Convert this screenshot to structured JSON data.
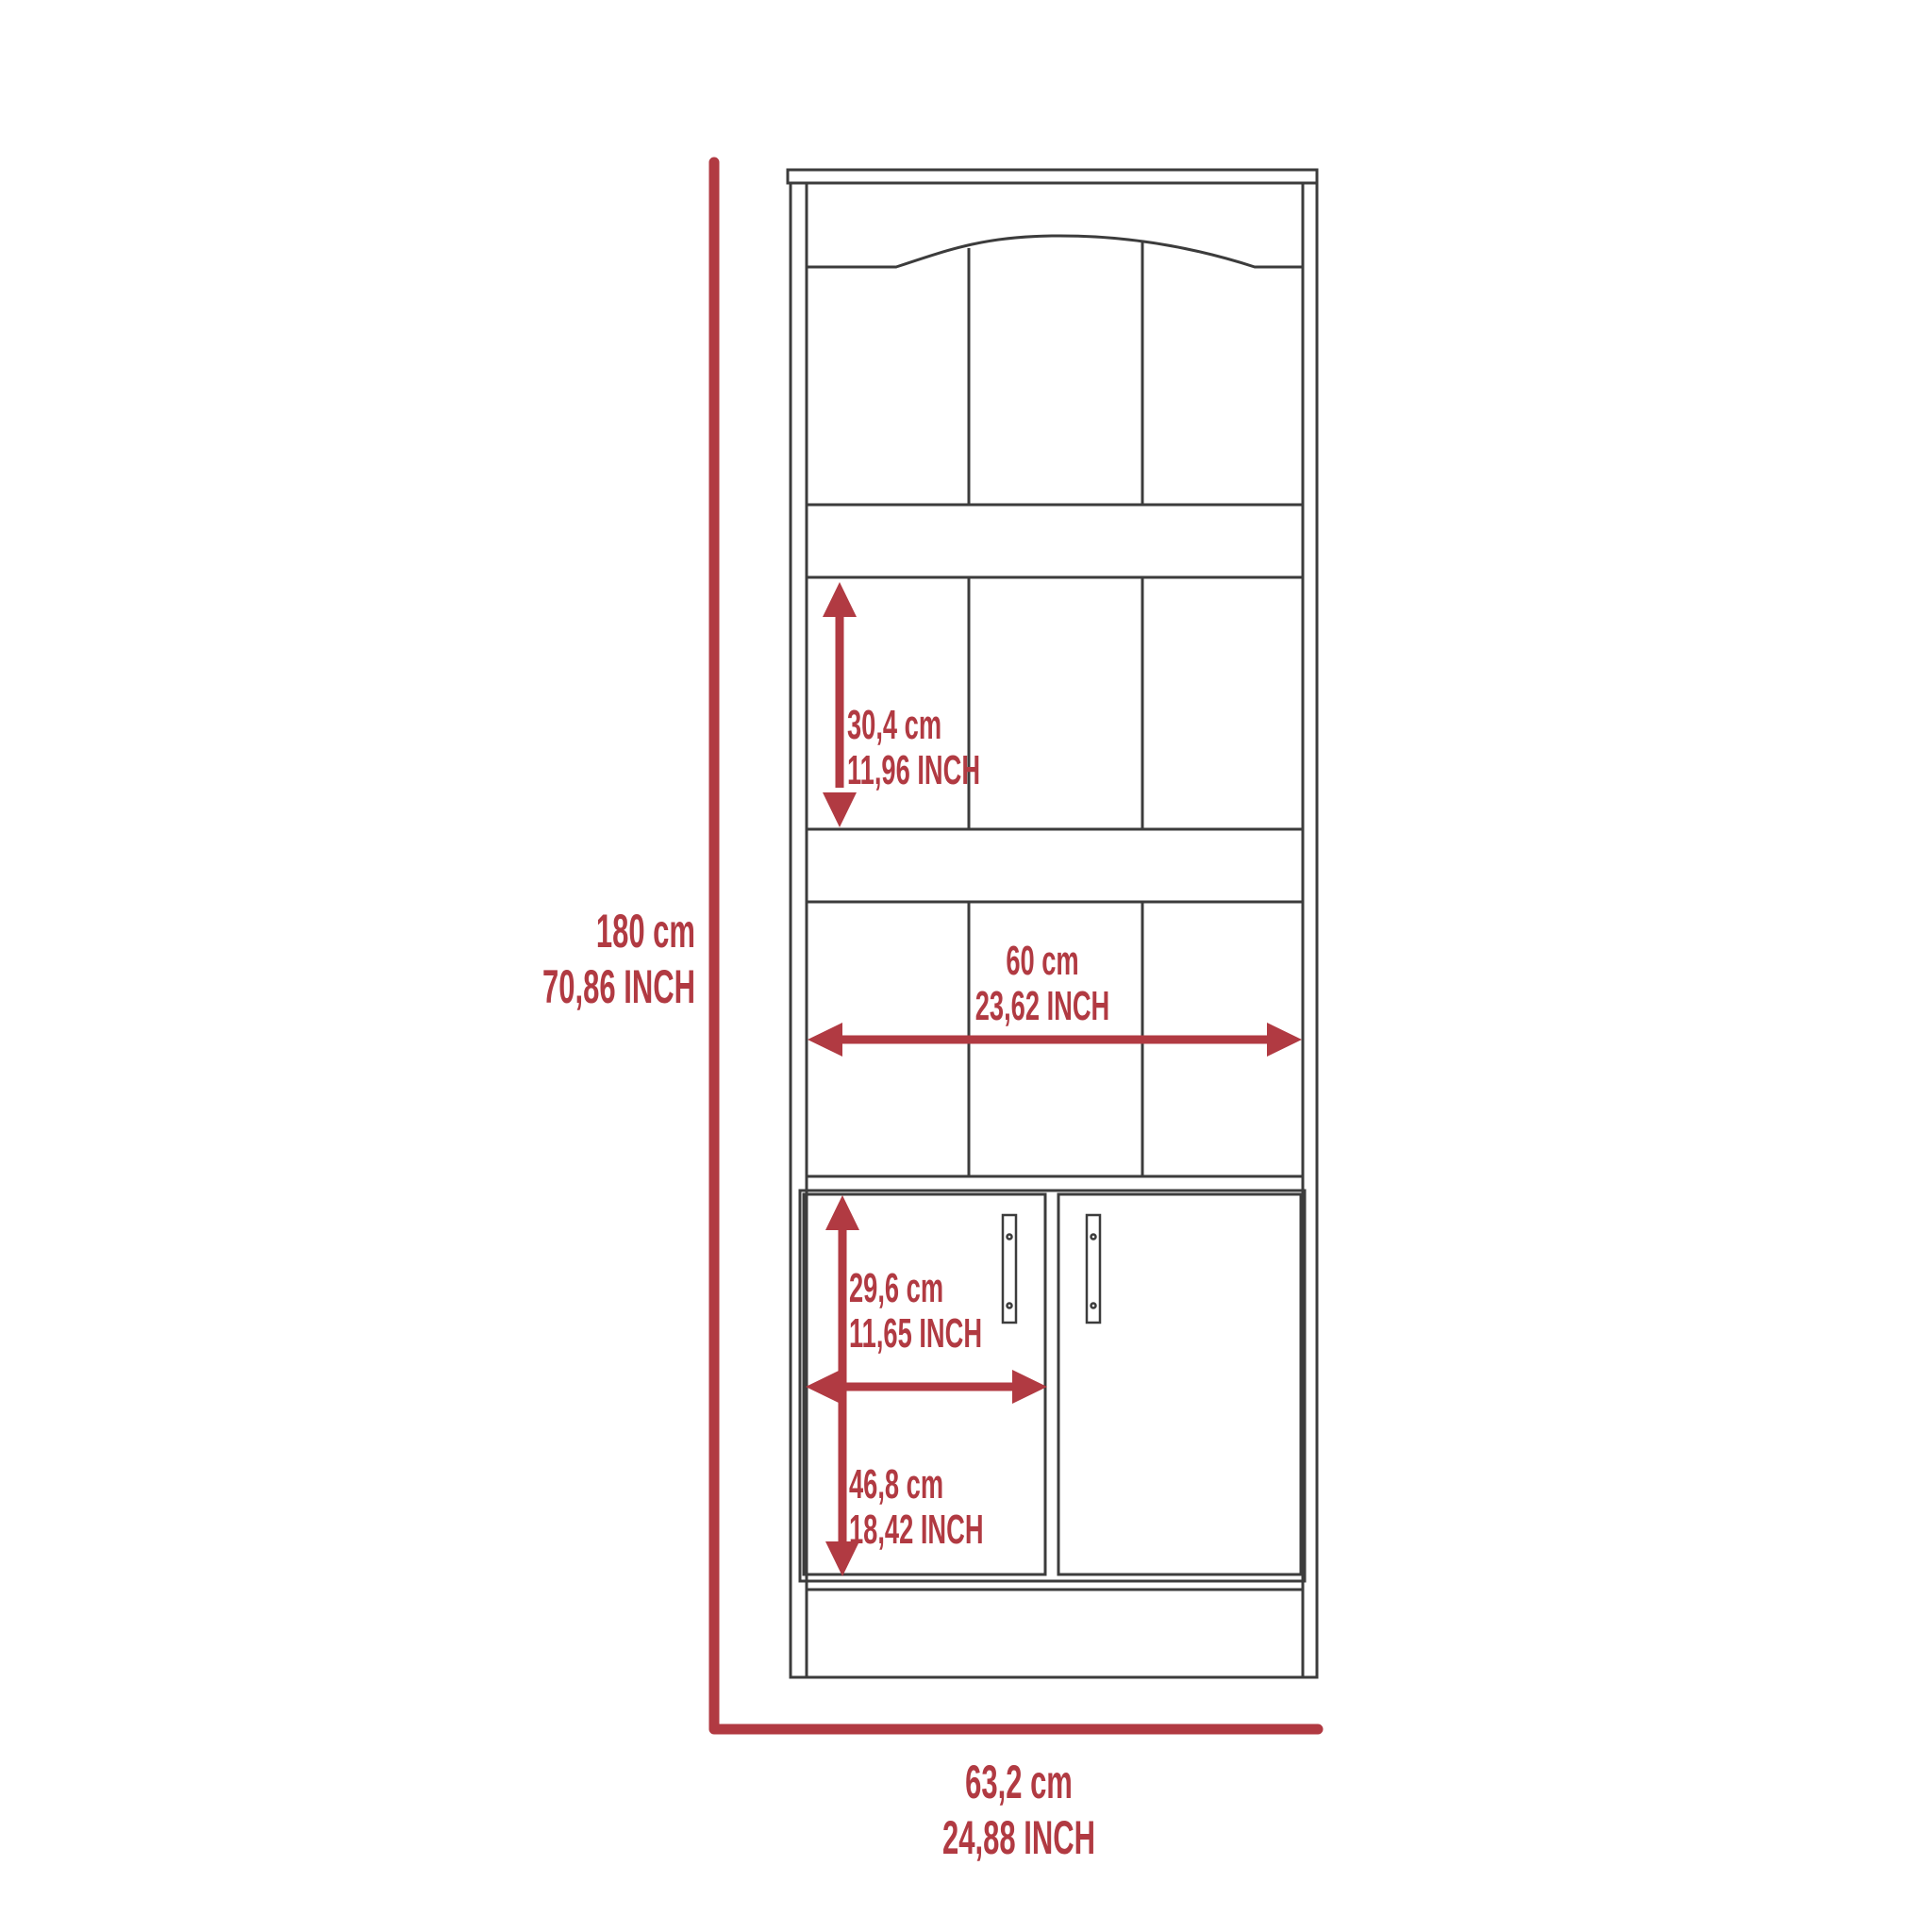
{
  "diagram": {
    "type": "furniture-dimension-diagram",
    "subject": "tall bookcase cabinet with lower double doors",
    "colors": {
      "dimension_red": "#b13a42",
      "outline_dark": "#3c3c3c",
      "background": "#ffffff"
    },
    "labels": {
      "overall_height": {
        "metric": "180 cm",
        "imperial": "70,86 INCH"
      },
      "overall_width": {
        "metric": "63,2 cm",
        "imperial": "24,88 INCH"
      },
      "shelf_height": {
        "metric": "30,4 cm",
        "imperial": "11,96 INCH"
      },
      "interior_width": {
        "metric": "60 cm",
        "imperial": "23,62 INCH"
      },
      "door_width": {
        "metric": "29,6 cm",
        "imperial": "11,65 INCH"
      },
      "door_height": {
        "metric": "46,8 cm",
        "imperial": "18,42 INCH"
      }
    }
  }
}
